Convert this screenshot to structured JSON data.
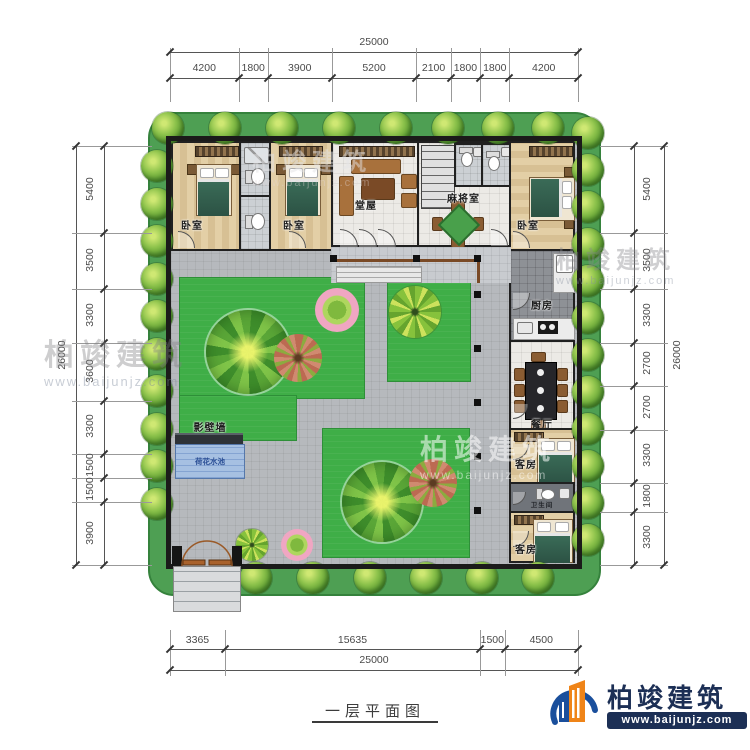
{
  "title": "一层平面图",
  "brand": {
    "name": "柏竣建筑",
    "url": "www.baijunjz.com"
  },
  "watermark": {
    "name": "柏竣建筑",
    "url": "www.baijunjz.com"
  },
  "dimensions": {
    "top": {
      "total": "25000",
      "segments": [
        "4200",
        "1800",
        "3900",
        "5200",
        "2100",
        "1800",
        "1800",
        "4200"
      ]
    },
    "bottom": {
      "total": "25000",
      "segments": [
        "3365",
        "15635",
        "1500",
        "4500"
      ]
    },
    "left": {
      "total": "26000",
      "segments": [
        "5400",
        "3500",
        "3300",
        "3600",
        "3300",
        "1500",
        "1500",
        "3900"
      ]
    },
    "right": {
      "total": "26000",
      "segments": [
        "5400",
        "3500",
        "3300",
        "2700",
        "2700",
        "3300",
        "1800",
        "3300"
      ]
    }
  },
  "rooms": {
    "bedroom": "卧室",
    "hall": "堂屋",
    "mahjong": "麻将室",
    "kitchen": "厨房",
    "dining": "餐厅",
    "guest": "客房",
    "bathroom": "卫生间",
    "screen_wall": "影壁墙",
    "lotus_pond": "荷花水池"
  }
}
